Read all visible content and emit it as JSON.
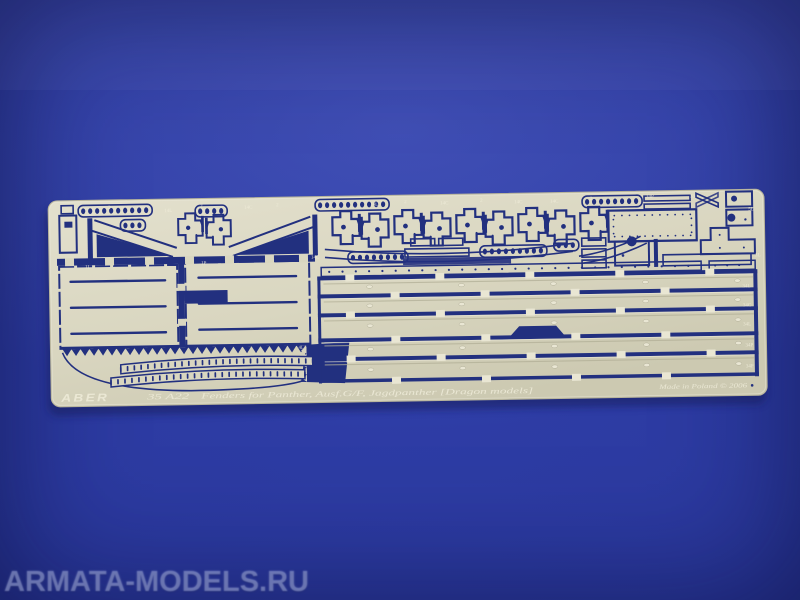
{
  "scene": {
    "subject": "Photo-etched brass detail fret for a 1/35 scale tank model, lying on a blue backdrop",
    "background_color": "#2a389c",
    "plate_color": "#d9d6c0",
    "cutout_color": "#22307f"
  },
  "watermark": {
    "text": "ARMATA-MODELS.RU"
  },
  "fret": {
    "brand": "ABER",
    "part_number": "35 A22",
    "title": "Fenders for Panther, Ausf.G/F, Jagdpanther [Dragon models]",
    "origin": "Made in Poland © 2006",
    "part_labels": [
      {
        "t": "2",
        "x": 60,
        "y": 5
      },
      {
        "t": "14L",
        "x": 116,
        "y": 9
      },
      {
        "t": "2",
        "x": 152,
        "y": 5
      },
      {
        "t": "14C",
        "x": 196,
        "y": 7
      },
      {
        "t": "2",
        "x": 228,
        "y": 5
      },
      {
        "t": "2",
        "x": 288,
        "y": 4
      },
      {
        "t": "14L",
        "x": 322,
        "y": 6
      },
      {
        "t": "2",
        "x": 356,
        "y": 4
      },
      {
        "t": "14C",
        "x": 392,
        "y": 6
      },
      {
        "t": "2",
        "x": 432,
        "y": 4
      },
      {
        "t": "14C",
        "x": 466,
        "y": 6
      },
      {
        "t": "14C",
        "x": 502,
        "y": 6
      },
      {
        "t": "2",
        "x": 542,
        "y": 4
      },
      {
        "t": "34P",
        "x": 598,
        "y": 3
      },
      {
        "t": "33",
        "x": 642,
        "y": 3
      },
      {
        "t": "5L",
        "x": 700,
        "y": 17
      },
      {
        "t": "1L",
        "x": 36,
        "y": 64
      },
      {
        "t": "1P",
        "x": 152,
        "y": 62
      },
      {
        "t": "14C",
        "x": 262,
        "y": 58
      },
      {
        "t": "3L",
        "x": 706,
        "y": 63
      },
      {
        "t": "34L",
        "x": 693,
        "y": 94
      },
      {
        "t": "34C",
        "x": 693,
        "y": 113
      },
      {
        "t": "34L",
        "x": 693,
        "y": 132
      },
      {
        "t": "34P",
        "x": 695,
        "y": 153
      },
      {
        "t": "34P",
        "x": 695,
        "y": 174
      },
      {
        "t": "4L",
        "x": 248,
        "y": 148
      }
    ]
  }
}
